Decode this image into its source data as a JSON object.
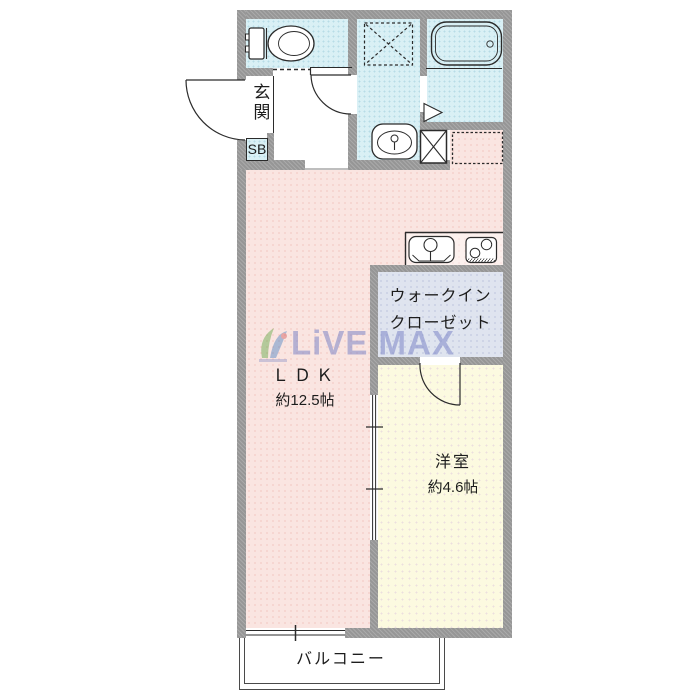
{
  "plan": {
    "type": "apartment-floorplan",
    "rooms": {
      "genkan": {
        "label": "玄関"
      },
      "shoebox": {
        "label": "SB"
      },
      "ldk": {
        "name": "ＬＤＫ",
        "size": "約12.5帖"
      },
      "walk_in_closet": {
        "label_line1": "ウォークイン",
        "label_line2": "クローゼット"
      },
      "bedroom": {
        "name": "洋室",
        "size": "約4.6帖"
      },
      "balcony": {
        "label": "バルコニー"
      }
    },
    "fixtures": [
      "toilet-icon",
      "bathtub-icon",
      "washbasin-icon",
      "kitchen-sink-icon",
      "stove-icon",
      "washing-machine-pan-icon",
      "laundry-space-dashed-icon",
      "refrigerator-space-dashed-icon",
      "entrance-door-arc",
      "washroom-door-arc",
      "bedroom-door-arc",
      "toilet-folding-door-dashed",
      "bathroom-folding-door",
      "sliding-door-marks",
      "balcony-window"
    ],
    "colors": {
      "wet_area": "#d9f0f5",
      "ldk": "#fae5e1",
      "bedroom": "#fcfae0",
      "closet": "#dfe4ef",
      "wall": "#9f9f9f",
      "balcony": "#ffffff",
      "line": "#2b2b2b",
      "watermark_text": "#7c85c6"
    }
  },
  "watermark": {
    "text": "LiVE MAX"
  }
}
